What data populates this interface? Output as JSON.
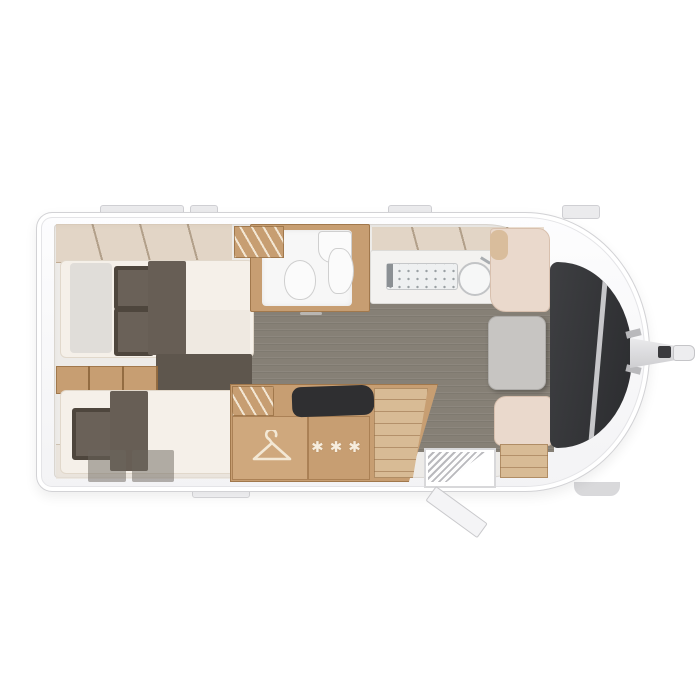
{
  "meta": {
    "view": "caravan-floorplan-top-view"
  },
  "symbols": {
    "fridge_stars": "✱✱✱",
    "wardrobe_icon": "hanger-icon",
    "kitchen_icons": [
      "sink-icon",
      "hob-icon"
    ],
    "bathroom_icons": [
      "toilet-icon",
      "washbasin-icon",
      "shower-icon"
    ]
  },
  "rooms": {
    "rear_bedroom": "twin-single-beds",
    "mid_top": "bathroom",
    "mid_bottom": "kitchen-block-with-wardrobe-and-fridge",
    "front": "dinette-with-table",
    "entry": "entrance-door-open-with-step"
  },
  "colors": {
    "body_shell": "#f6f6f8",
    "wood": "#c79e72",
    "wood_light": "#d8bb95",
    "floor": "#868076",
    "mattress": "#f5f0e9",
    "upholstery_dark": "#5e564d",
    "dinette_upholstery": "#ead9cc",
    "table": "#c7c5c2",
    "front_panel": "#323336",
    "fixtures": "#fbfbfb"
  }
}
